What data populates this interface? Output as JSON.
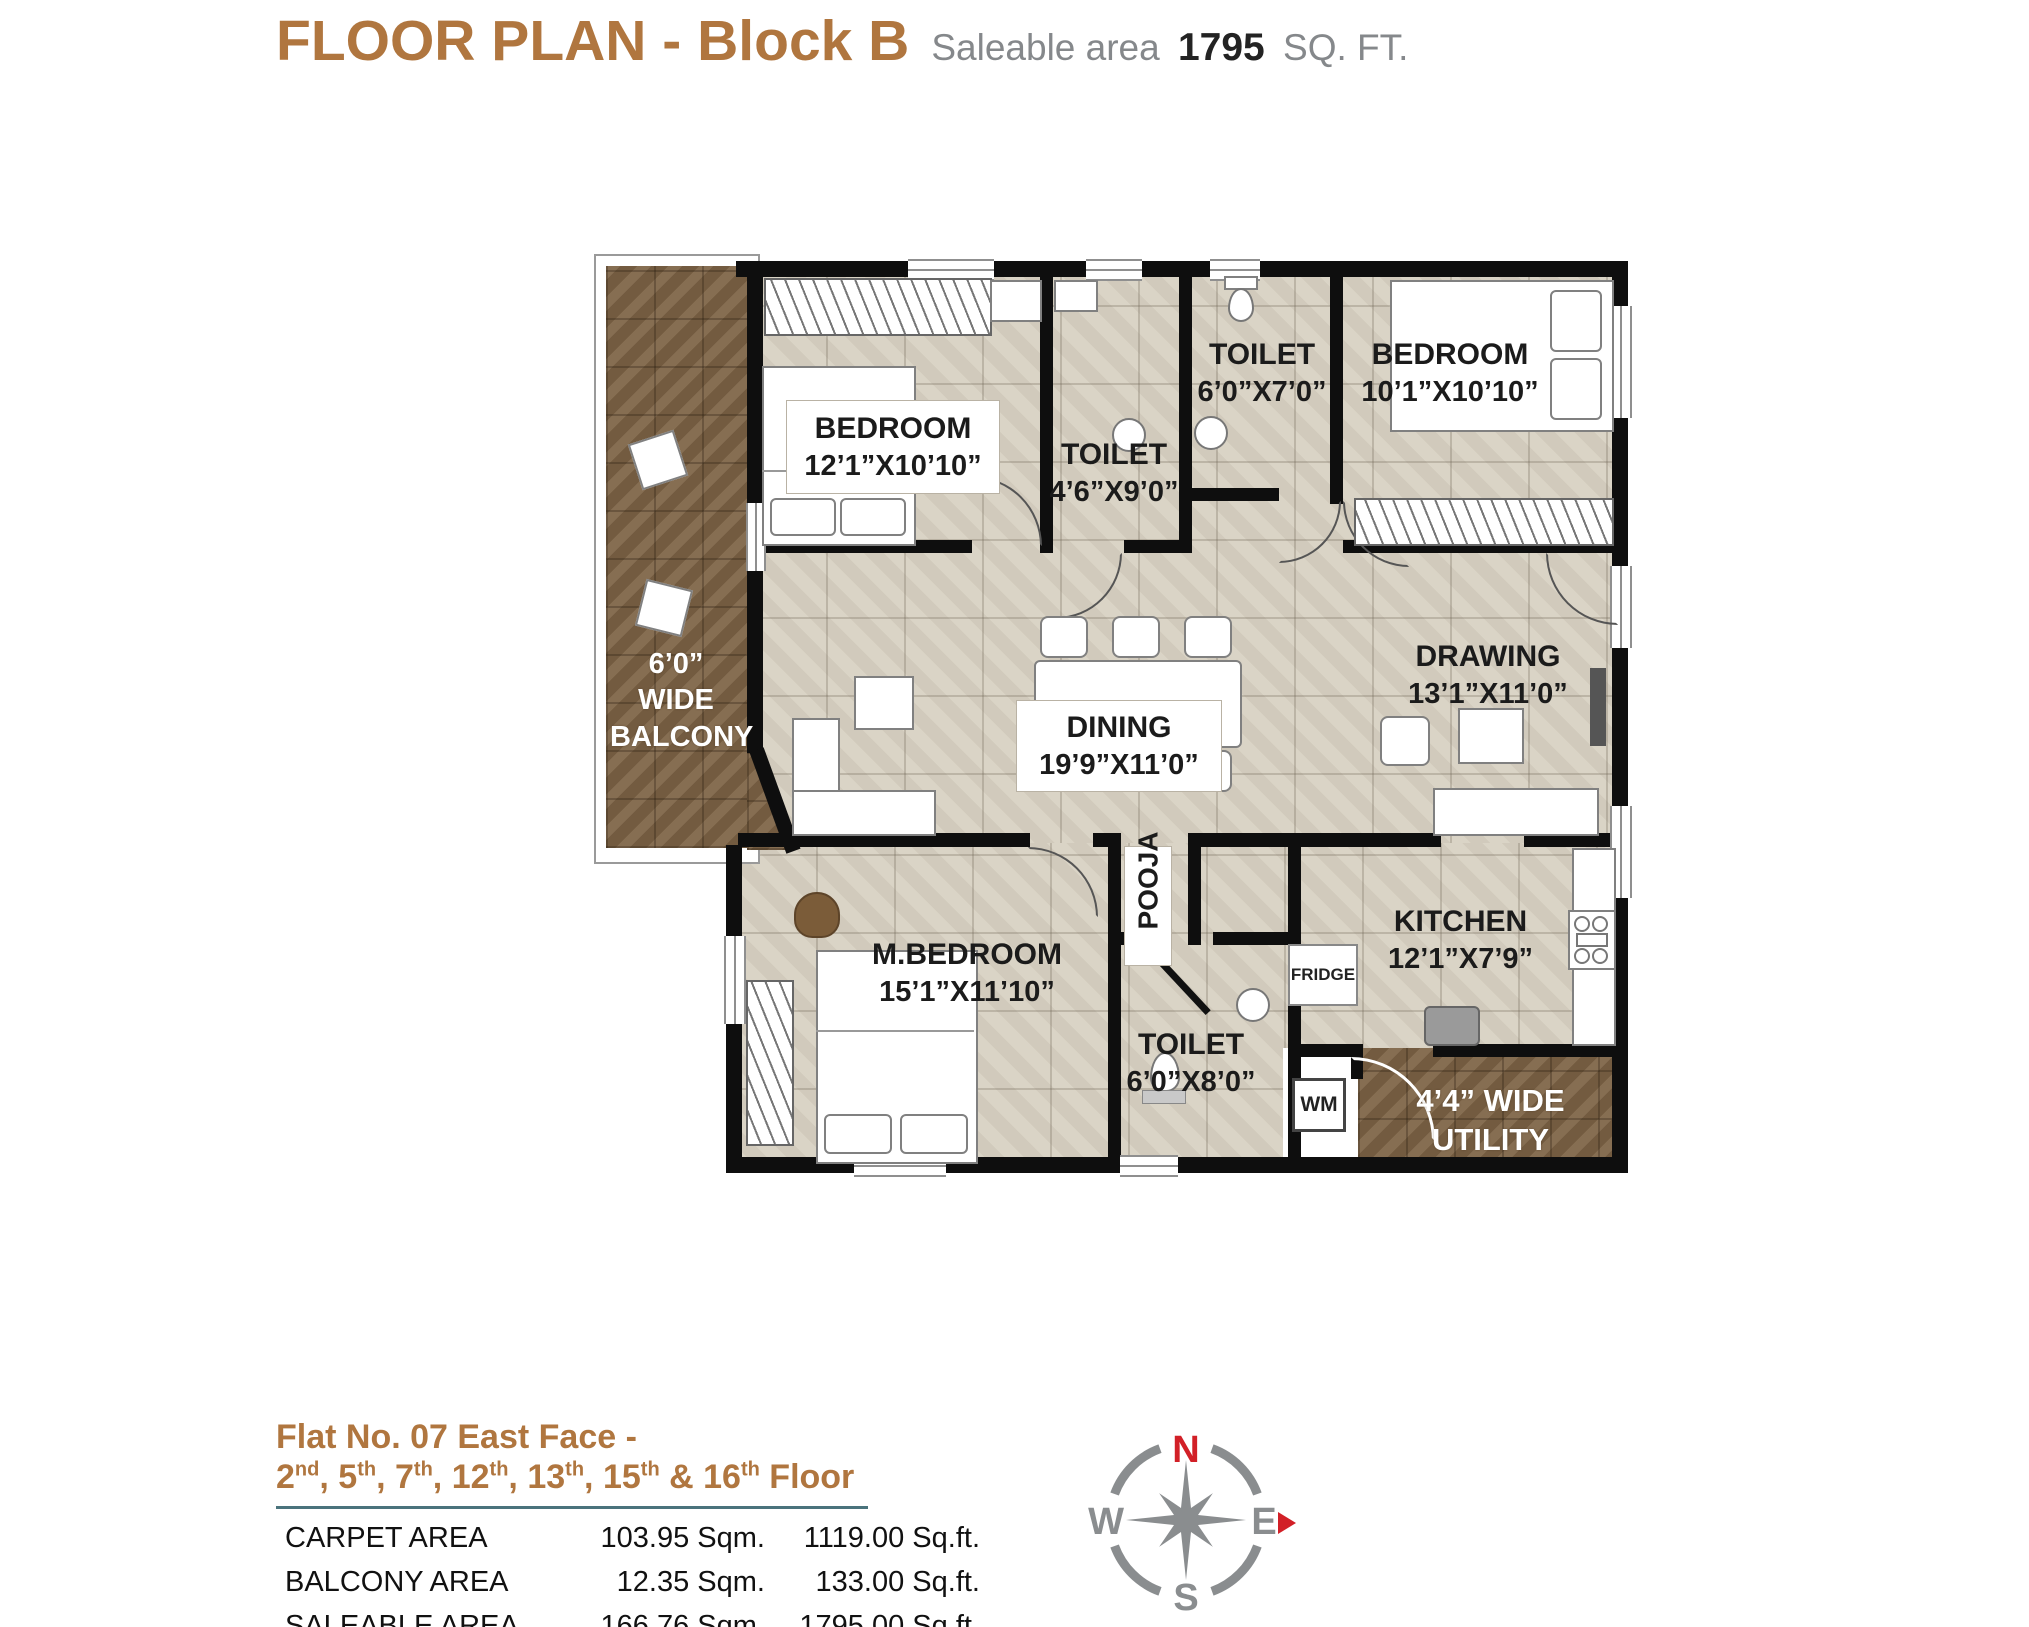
{
  "header": {
    "title": "FLOOR PLAN - Block B",
    "saleable_prefix": "Saleable area",
    "saleable_value": "1795",
    "saleable_suffix": "SQ. FT."
  },
  "plan": {
    "rooms": {
      "bedroom1": {
        "name": "BEDROOM",
        "dims": "12’1”X10’10”"
      },
      "toilet_mid": {
        "name": "TOILET",
        "dims": "4’6”X9’0”"
      },
      "toilet_top": {
        "name": "TOILET",
        "dims": "6’0”X7’0”"
      },
      "bedroom2": {
        "name": "BEDROOM",
        "dims": "10’1”X10’10”"
      },
      "dining": {
        "name": "DINING",
        "dims": "19’9”X11’0”"
      },
      "drawing": {
        "name": "DRAWING",
        "dims": "13’1”X11’0”"
      },
      "mbedroom": {
        "name": "M.BEDROOM",
        "dims": "15’1”X11’10”"
      },
      "toilet_bottom": {
        "name": "TOILET",
        "dims": "6’0”X8’0”"
      },
      "kitchen": {
        "name": "KITCHEN",
        "dims": "12’1”X7’9”"
      },
      "pooja": {
        "name": "POOJA"
      }
    },
    "balcony": {
      "line1": "6’0”",
      "line2": "WIDE",
      "line3": "BALCONY"
    },
    "utility": {
      "line1": "4’4” WIDE",
      "line2": "UTILITY"
    },
    "appliances": {
      "fridge": "FRIDGE",
      "wm": "WM"
    }
  },
  "footer": {
    "flat_title": "Flat No. 07 East Face -",
    "floors": [
      {
        "num": "2",
        "sup": "nd",
        "sep": ", "
      },
      {
        "num": "5",
        "sup": "th",
        "sep": ", "
      },
      {
        "num": "7",
        "sup": "th",
        "sep": ", "
      },
      {
        "num": "12",
        "sup": "th",
        "sep": ", "
      },
      {
        "num": "13",
        "sup": "th",
        "sep": ", "
      },
      {
        "num": "15",
        "sup": "th",
        "sep": " & "
      },
      {
        "num": "16",
        "sup": "th",
        "sep": " "
      }
    ],
    "floors_suffix": "Floor",
    "table": {
      "rows": [
        {
          "label": "CARPET AREA",
          "sqm": "103.95 Sqm.",
          "sqft": "1119.00 Sq.ft."
        },
        {
          "label": "BALCONY AREA",
          "sqm": "12.35 Sqm.",
          "sqft": "133.00 Sq.ft."
        },
        {
          "label": "SALEABLE AREA",
          "sqm": "166.76 Sqm.",
          "sqft": "1795.00 Sq.ft."
        }
      ]
    }
  },
  "compass": {
    "n": "N",
    "e": "E",
    "s": "S",
    "w": "W"
  },
  "colors": {
    "title_brown": "#b0763f",
    "text_gray": "#85888b",
    "text_dark": "#232323",
    "floor_beige": "#d8d1c2",
    "balcony_brown": "#7d6345",
    "wall_black": "#0e0e0e",
    "divider_teal": "#4a737c",
    "compass_gray": "#8a8d8f",
    "compass_red": "#d22027"
  }
}
